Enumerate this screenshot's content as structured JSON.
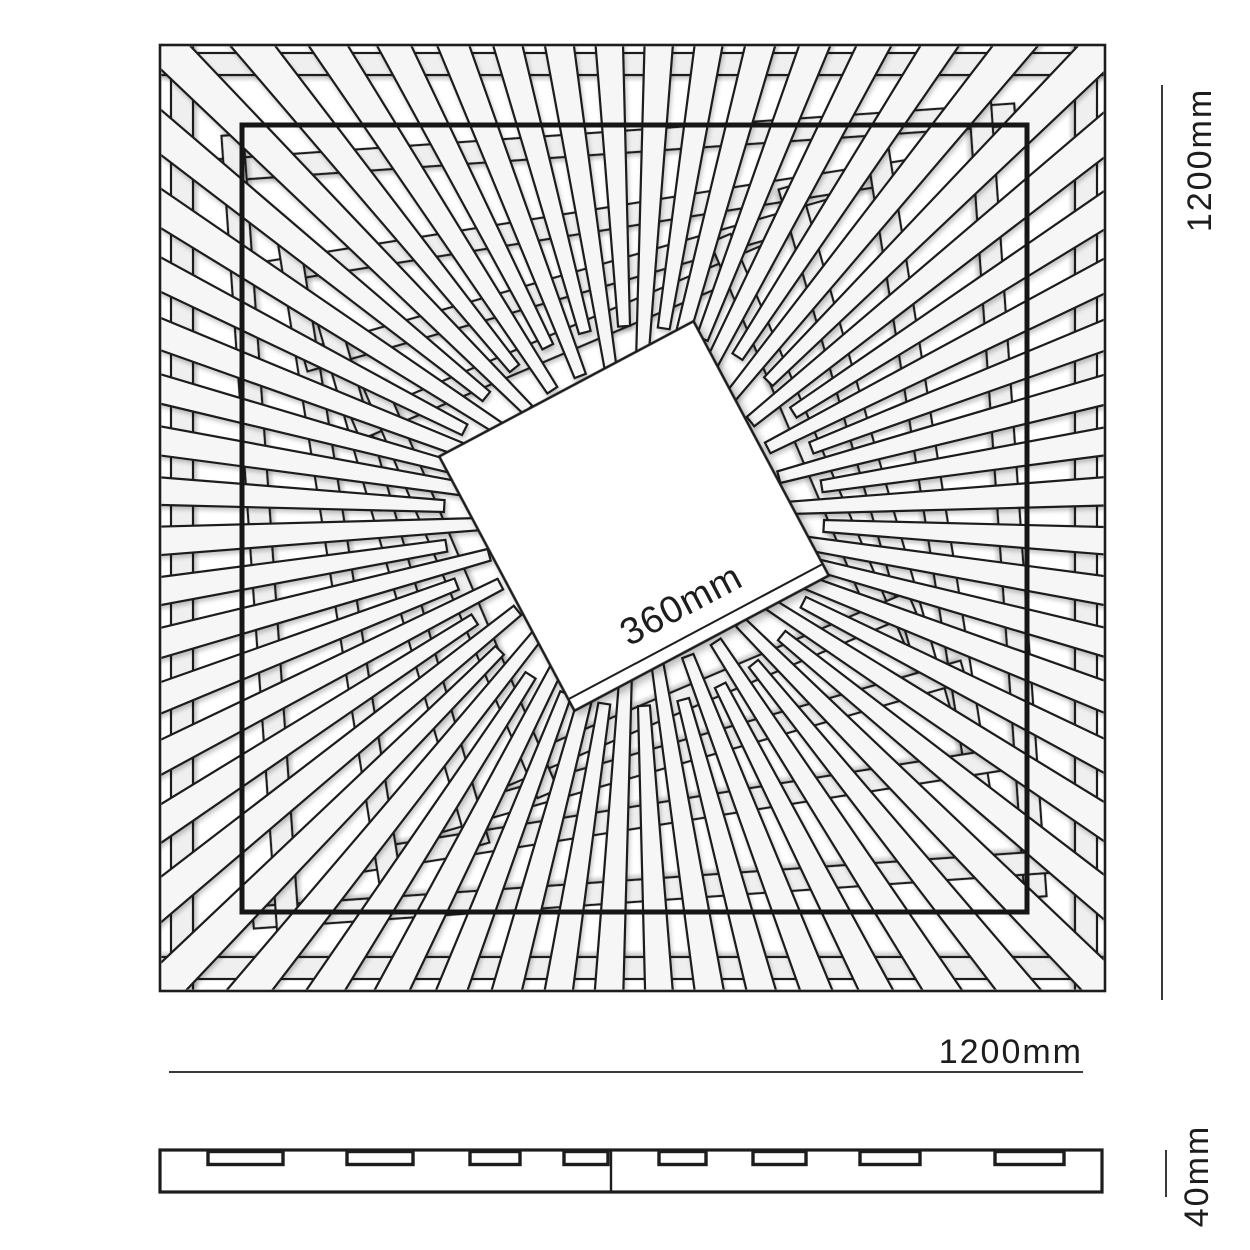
{
  "labels": {
    "height": "1200mm",
    "width": "1200mm",
    "center": "360mm",
    "thickness": "40mm"
  },
  "colors": {
    "line": "#1d1d1d",
    "slat_fill": "#f6f6f6",
    "ring_fill": "#efefef",
    "background": "#ffffff"
  },
  "pattern": {
    "spoke_count": 60,
    "spoke_angle_offset_deg": -3,
    "spoke_inner_radii": [
      150,
      190
    ],
    "spoke_outer_radius": 700,
    "spoke_inner_width": 12,
    "spoke_outer_width": 40,
    "slat_width": 22,
    "rings": [
      {
        "half_side": 452,
        "rotation_deg": 0
      },
      {
        "half_side": 374,
        "rotation_deg": -4
      },
      {
        "half_side": 298,
        "rotation_deg": -9
      },
      {
        "half_side": 240,
        "rotation_deg": -16
      },
      {
        "half_side": 188,
        "rotation_deg": -23
      }
    ],
    "center_square": {
      "side": 288,
      "rotation_deg": -28
    }
  },
  "side_profile": {
    "notches": [
      {
        "x": 208,
        "w": 75
      },
      {
        "x": 347,
        "w": 66
      },
      {
        "x": 470,
        "w": 50
      },
      {
        "x": 564,
        "w": 44
      },
      {
        "x": 659,
        "w": 47
      },
      {
        "x": 753,
        "w": 53
      },
      {
        "x": 860,
        "w": 60
      },
      {
        "x": 995,
        "w": 69
      }
    ]
  }
}
